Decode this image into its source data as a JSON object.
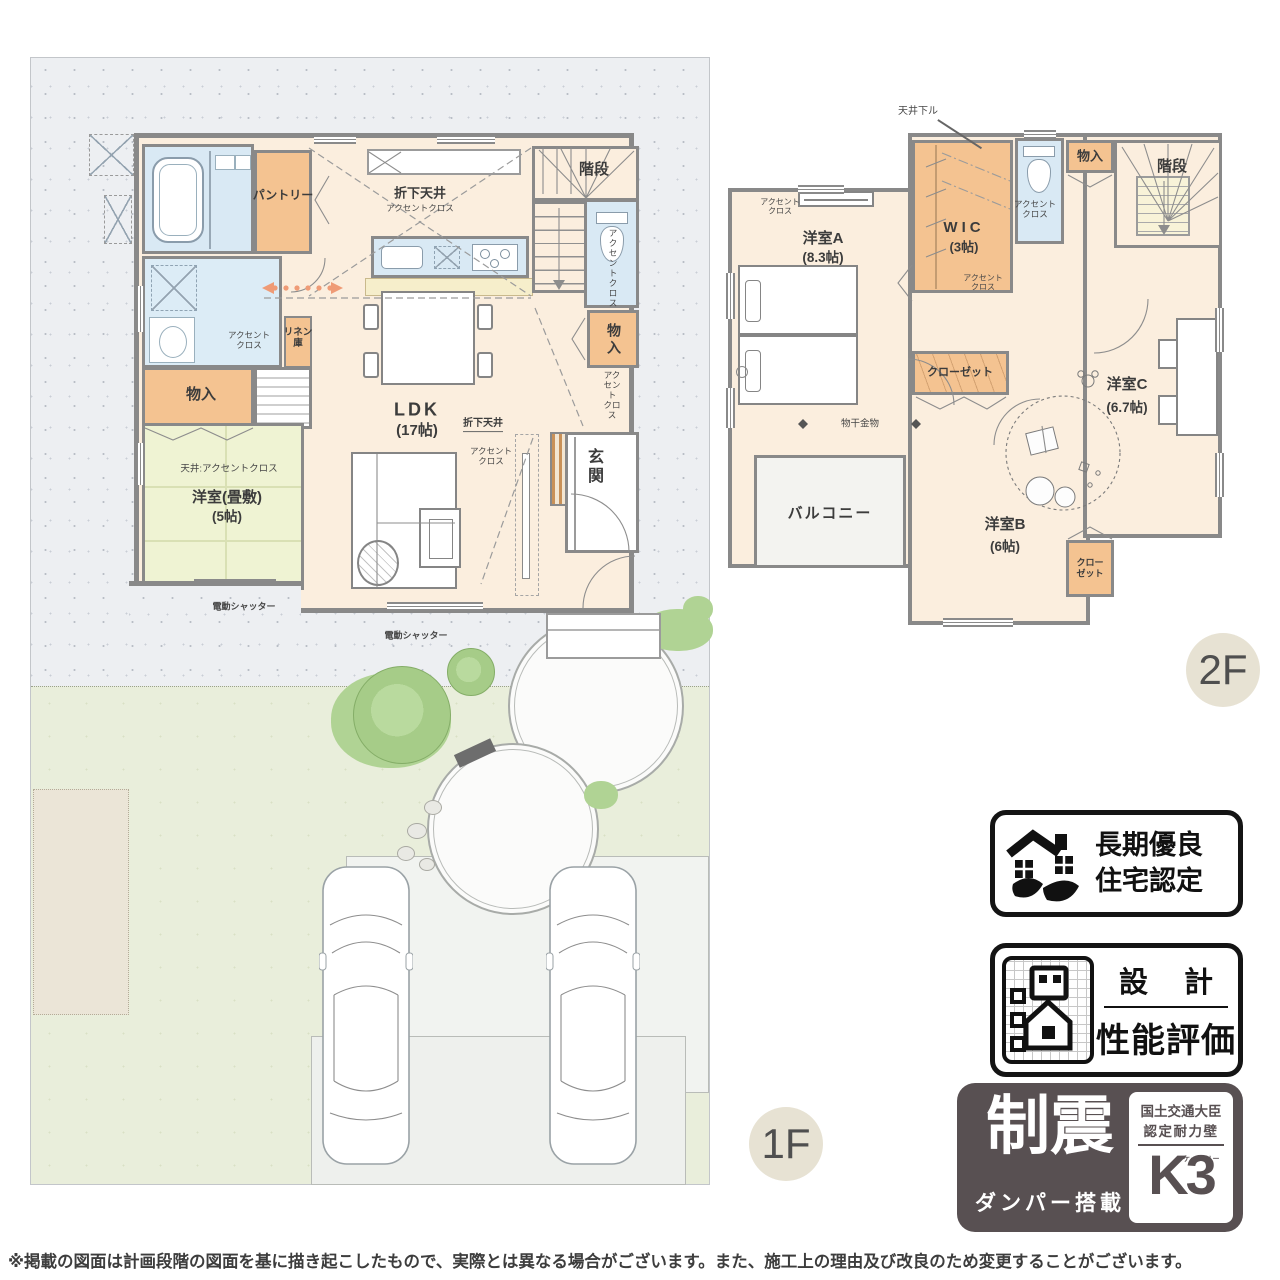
{
  "floor_badges": {
    "f1": "1F",
    "f2": "2F"
  },
  "common": {
    "accent": "アクセントクロス",
    "accent2": "アクセント\nクロス",
    "monoire": "物入",
    "kaidan": "階段",
    "closet": "クローゼット",
    "closet2": "クロー\nゼット",
    "shutter": "電動シャッター"
  },
  "f1": {
    "pantry": "パントリー",
    "linen": "リネン\n庫",
    "orishita": "折下天井",
    "ldk": "LDK",
    "ldk_size": "(17帖)",
    "ceiling_accent": "天井:アクセントクロス",
    "tatami": "洋室(畳敷)",
    "tatami_size": "(5帖)",
    "genkan": "玄関"
  },
  "f2": {
    "tenjo": "天井下ル",
    "room_a": "洋室A",
    "room_a_size": "(8.3帖)",
    "wic": "WIC",
    "wic_size": "(3帖)",
    "room_b": "洋室B",
    "room_b_size": "(6帖)",
    "room_c": "洋室C",
    "room_c_size": "(6.7帖)",
    "balcony": "バルコニー",
    "monohoshi": "物干金物"
  },
  "badges": {
    "longterm": {
      "line1": "長期優良",
      "line2": "住宅認定"
    },
    "design": {
      "top": "設 計",
      "bottom": "性能評価"
    },
    "seismic": {
      "main": "制震",
      "sub": "ダンパー搭載",
      "right1": "国土交通大臣",
      "right2": "認定耐力壁",
      "k3_small": "ケースリー",
      "k3": "K3"
    }
  },
  "disclaimer": "※掲載の図面は計画段階の図面を基に描き起こしたもので、実際とは異なる場合がございます。また、施工上の理由及び改良のため変更することがございます。"
}
